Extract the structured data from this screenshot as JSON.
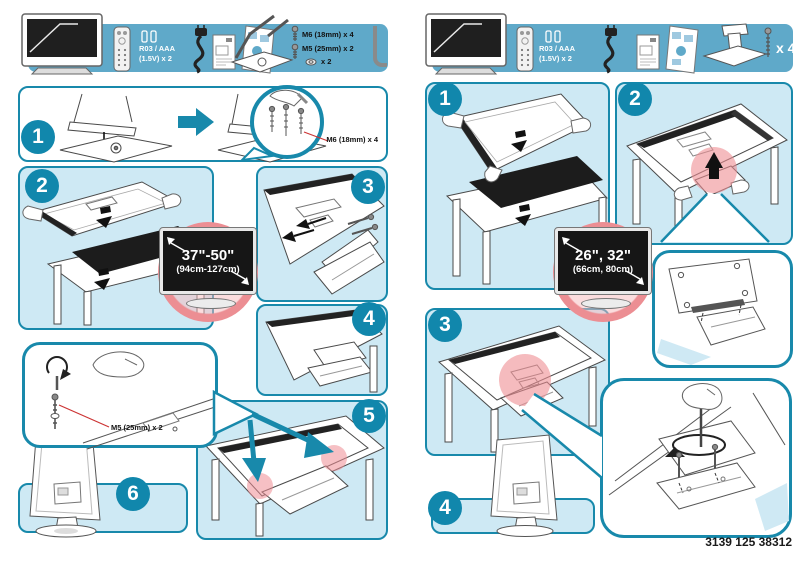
{
  "colors": {
    "accent_teal": "#1889ab",
    "strip_blue": "#5fa9c9",
    "panel_blue": "#cee9f4",
    "highlight_pink": "#ec8e93",
    "screen_black": "#161616",
    "leader_red": "#cc3333"
  },
  "icons": {
    "tv-icon": "television front view",
    "remote-icon": "remote control",
    "battery-icon": "two AAA batteries",
    "power-cable-icon": "mains cord with plug",
    "manual-icon": "user manual booklet",
    "setup-poster-icon": "quick start poster",
    "stand-neck-icon": "stand column part",
    "stand-base-icon": "stand base plate",
    "screw-icon": "machine screw",
    "washer-icon": "washer",
    "allen-key-icon": "hex key",
    "screwdriver-icon": "screwdriver"
  },
  "left_page": {
    "strip": {
      "battery_line1": "R03 / AAA",
      "battery_line2": "(1.5V) x 2",
      "m6_label": "M6 (18mm) x 4",
      "m5_label": "M5 (25mm) x 2",
      "washer_qty": "x 2"
    },
    "steps": [
      "1",
      "2",
      "3",
      "4",
      "5",
      "6"
    ],
    "step1_screw_label": "M6 (18mm) x 4",
    "balloon_screw_label": "M5 (25mm) x 2",
    "size_badge": {
      "inches": "37\"-50\"",
      "cm": "(94cm-127cm)"
    }
  },
  "right_page": {
    "strip": {
      "battery_line1": "R03 / AAA",
      "battery_line2": "(1.5V) x 2",
      "screw_qty": "x 4"
    },
    "steps": [
      "1",
      "2",
      "3",
      "4"
    ],
    "size_badge": {
      "inches": "26\", 32\"",
      "cm": "(66cm, 80cm)"
    }
  },
  "footer": {
    "part_number": "3139 125 38312"
  }
}
